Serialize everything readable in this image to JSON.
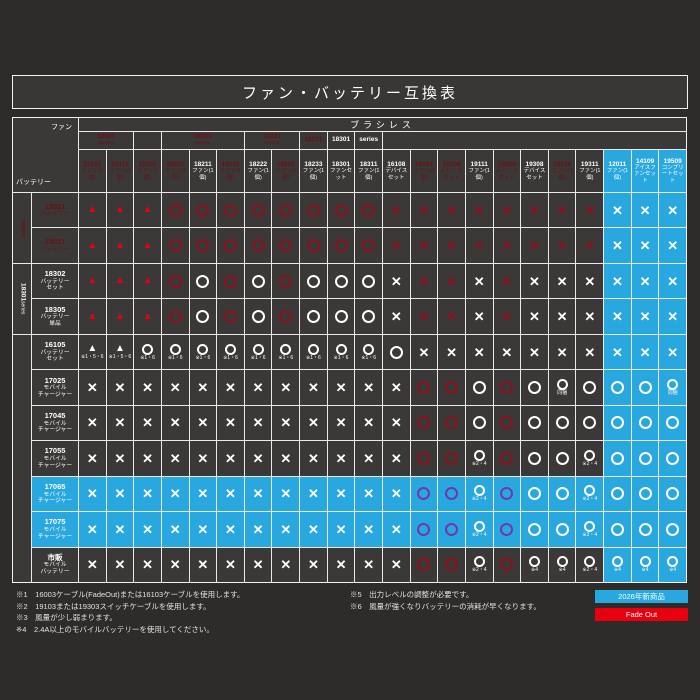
{
  "title": "ファン・バッテリー互換表",
  "band": "ブラシレス",
  "axis": {
    "fan": "ファン",
    "battery": "バッテリー"
  },
  "colors": {
    "blue": "#29a8e0",
    "red_bright": "#e8000f",
    "red_dark": "#8b1020",
    "purple": "#7038aa",
    "cell_bg": "#3a3938"
  },
  "groups": [
    {
      "text": "12001 series",
      "type": "red",
      "span": 2
    },
    {
      "text": "",
      "type": "diagonal",
      "span": 1
    },
    {
      "text": "18201 series",
      "type": "red",
      "span": 3
    },
    {
      "text": "18221 series",
      "type": "red",
      "span": 2
    },
    {
      "text": "18231",
      "type": "red",
      "span": 1
    },
    {
      "text": "18301",
      "type": "white",
      "span": 1
    },
    {
      "text": "series",
      "type": "white",
      "span": 1
    },
    {
      "text": "",
      "type": "diagonal",
      "span": 11
    }
  ],
  "columns": [
    {
      "code": "12101",
      "name": "ファン(1個)",
      "type": "red"
    },
    {
      "code": "12111",
      "name": "ファン(1個)",
      "type": "red"
    },
    {
      "code": "13101",
      "name": "ファン(1個)",
      "type": "red"
    },
    {
      "code": "18201",
      "name": "ファン(1個)",
      "type": "red"
    },
    {
      "code": "18211",
      "name": "ファン(1個)",
      "type": "white"
    },
    {
      "code": "18221",
      "name": "ファン(1個)",
      "type": "red"
    },
    {
      "code": "18222",
      "name": "ファン(1個)",
      "type": "white"
    },
    {
      "code": "18231",
      "name": "ファン(1個)",
      "type": "red"
    },
    {
      "code": "18233",
      "name": "ファン(1個)",
      "type": "white"
    },
    {
      "code": "18301",
      "name": "ファンセット",
      "type": "white"
    },
    {
      "code": "18311",
      "name": "ファン(1個)",
      "type": "white"
    },
    {
      "code": "16108",
      "name": "デバイスセット",
      "type": "white"
    },
    {
      "code": "19101",
      "name": "ファン(1個)",
      "type": "red"
    },
    {
      "code": "19108",
      "name": "デバイスセット",
      "type": "red"
    },
    {
      "code": "19111",
      "name": "ファン(1個)",
      "type": "white"
    },
    {
      "code": "19208",
      "name": "デバイスセット",
      "type": "red"
    },
    {
      "code": "19308",
      "name": "デバイスセット",
      "type": "white"
    },
    {
      "code": "19211",
      "name": "ファン(1個)",
      "type": "red"
    },
    {
      "code": "19311",
      "name": "ファン(1個)",
      "type": "white"
    },
    {
      "code": "12011",
      "name": "ファン(1個)",
      "type": "blue"
    },
    {
      "code": "14109",
      "name": "アイスファンセット",
      "type": "blue"
    },
    {
      "code": "19509",
      "name": "コンプリートセット",
      "type": "blue"
    }
  ],
  "strip": [
    {
      "rows": [
        1,
        2
      ],
      "text": "series",
      "type": "red"
    },
    {
      "rows": [
        3,
        4
      ],
      "text": "18301 series",
      "type": "white"
    },
    {
      "rows": [
        5,
        11
      ],
      "text": "",
      "type": "diagonal"
    }
  ],
  "rows": [
    {
      "code": "12021",
      "lines": [
        "バッテリー"
      ],
      "type": "red",
      "cells": [
        "t|br",
        "t|br",
        "t|br",
        "o|dr",
        "o|dr",
        "o|dr",
        "o|dr",
        "o|dr",
        "o|dr",
        "o|dr",
        "o|dr",
        "x|dr",
        "x|dr",
        "x|dr",
        "x|dr",
        "x|dr",
        "x|dr",
        "x|dr",
        "x|dr",
        "x|w",
        "x|w",
        "x|w"
      ]
    },
    {
      "code": "13021",
      "lines": [
        "バッテリー"
      ],
      "type": "red",
      "cells": [
        "t|br",
        "t|br",
        "t|br",
        "o|dr",
        "o|dr",
        "o|dr",
        "o|dr",
        "o|dr",
        "o|dr",
        "o|dr",
        "o|dr",
        "x|dr",
        "x|dr",
        "x|dr",
        "x|dr",
        "x|dr",
        "x|dr",
        "x|dr",
        "x|dr",
        "x|w",
        "x|w",
        "x|w"
      ]
    },
    {
      "code": "18302",
      "lines": [
        "バッテリー",
        "セット"
      ],
      "type": "white",
      "cells": [
        "t|br",
        "t|br",
        "t|br",
        "o|dr",
        "o|w",
        "o|dr",
        "o|w",
        "o|dr",
        "o|w",
        "o|w",
        "o|w",
        "x|w",
        "x|dr",
        "x|dr",
        "x|w",
        "x|dr",
        "x|w",
        "x|w",
        "x|w",
        "x|w",
        "x|w",
        "x|w"
      ]
    },
    {
      "code": "18305",
      "lines": [
        "バッテリー",
        "単品"
      ],
      "type": "white",
      "cells": [
        "t|br",
        "t|br",
        "t|br",
        "o|dr",
        "o|w",
        "o|dr",
        "o|w",
        "o|dr",
        "o|w",
        "o|w",
        "o|w",
        "x|w",
        "x|dr",
        "x|dr",
        "x|w",
        "x|dr",
        "x|w",
        "x|w",
        "x|w",
        "x|w",
        "x|w",
        "x|w"
      ]
    },
    {
      "code": "16105",
      "lines": [
        "バッテリー",
        "セット"
      ],
      "type": "white",
      "cells": [
        "t|w|※1・5・6",
        "t|w|※1・5・6",
        "o|w|※1・6",
        "o|w|※1・6",
        "o|w|※1・6",
        "o|w|※1・6",
        "o|w|※1・6",
        "o|w|※1・6",
        "o|w|※1・6",
        "o|w|※1・6",
        "o|w|※1・6",
        "o|w",
        "x|w",
        "x|w",
        "x|w",
        "x|w",
        "x|w",
        "x|w",
        "x|w",
        "x|w",
        "x|w",
        "x|w"
      ]
    },
    {
      "code": "17025",
      "lines": [
        "モバイル",
        "チャージャー"
      ],
      "type": "white",
      "cells": [
        "x|w",
        "x|w",
        "x|w",
        "x|w",
        "x|w",
        "x|w",
        "x|w",
        "x|w",
        "x|w",
        "x|w",
        "x|w",
        "x|w",
        "o|dr",
        "o|dr",
        "o|w",
        "o|dr",
        "o|w",
        "o|w|同梱",
        "o|w",
        "o|w",
        "o|w",
        "o|w|同梱"
      ]
    },
    {
      "code": "17045",
      "lines": [
        "モバイル",
        "チャージャー"
      ],
      "type": "white",
      "cells": [
        "x|w",
        "x|w",
        "x|w",
        "x|w",
        "x|w",
        "x|w",
        "x|w",
        "x|w",
        "x|w",
        "x|w",
        "x|w",
        "x|w",
        "o|dr",
        "o|dr",
        "o|w",
        "o|dr",
        "o|w",
        "o|w",
        "o|w",
        "o|w",
        "o|w",
        "o|w"
      ]
    },
    {
      "code": "17055",
      "lines": [
        "モバイル",
        "チャージャー"
      ],
      "type": "white",
      "cells": [
        "x|w",
        "x|w",
        "x|w",
        "x|w",
        "x|w",
        "x|w",
        "x|w",
        "x|w",
        "x|w",
        "x|w",
        "x|w",
        "x|w",
        "o|dr",
        "o|dr",
        "o|w|※2・4",
        "o|dr",
        "o|w",
        "o|w",
        "o|w|※2・4",
        "o|w",
        "o|w",
        "o|w"
      ]
    },
    {
      "code": "17065",
      "lines": [
        "モバイル",
        "チャージャー"
      ],
      "type": "blue",
      "cells": [
        "x|w",
        "x|w",
        "x|w",
        "x|w",
        "x|w",
        "x|w",
        "x|w",
        "x|w",
        "x|w",
        "x|w",
        "x|w",
        "x|w",
        "o|pu",
        "o|pu",
        "o|w|※2・4",
        "o|pu",
        "o|w",
        "o|w",
        "o|w|※2・4",
        "o|w",
        "o|w",
        "o|w"
      ]
    },
    {
      "code": "17075",
      "lines": [
        "モバイル",
        "チャージャー"
      ],
      "type": "blue",
      "cells": [
        "x|w",
        "x|w",
        "x|w",
        "x|w",
        "x|w",
        "x|w",
        "x|w",
        "x|w",
        "x|w",
        "x|w",
        "x|w",
        "x|w",
        "o|pu",
        "o|pu",
        "o|w|※2・4",
        "o|pu",
        "o|w",
        "o|w",
        "o|w|※2・4",
        "o|w",
        "o|w",
        "o|w"
      ]
    },
    {
      "code": "市販",
      "lines": [
        "モバイル",
        "バッテリー"
      ],
      "type": "white",
      "cells": [
        "x|w",
        "x|w",
        "x|w",
        "x|w",
        "x|w",
        "x|w",
        "x|w",
        "x|w",
        "x|w",
        "x|w",
        "x|w",
        "x|w",
        "o|dr",
        "o|dr",
        "o|w|※2・4",
        "o|dr",
        "o|w|※4",
        "o|w|※4",
        "o|w|※2・4",
        "o|w|※4",
        "o|w|※4",
        "o|w|※4"
      ]
    }
  ],
  "footnotes_left": [
    "※1　16003ケーブル(FadeOut)または16103ケーブルを使用します。",
    "※2　19103または19303スイッチケーブルを使用します。",
    "※3　風量が少し弱まります。",
    "※4　2.4A以上のモバイルバッテリーを使用してください。"
  ],
  "footnotes_right": [
    "※5　出力レベルの調整が必要です。",
    "※6　風量が強くなりバッテリーの消耗が早くなります。"
  ],
  "legend": [
    {
      "label": "2026年新商品",
      "color": "#29a8e0"
    },
    {
      "label": "Fade Out",
      "color": "#e8000f"
    }
  ]
}
